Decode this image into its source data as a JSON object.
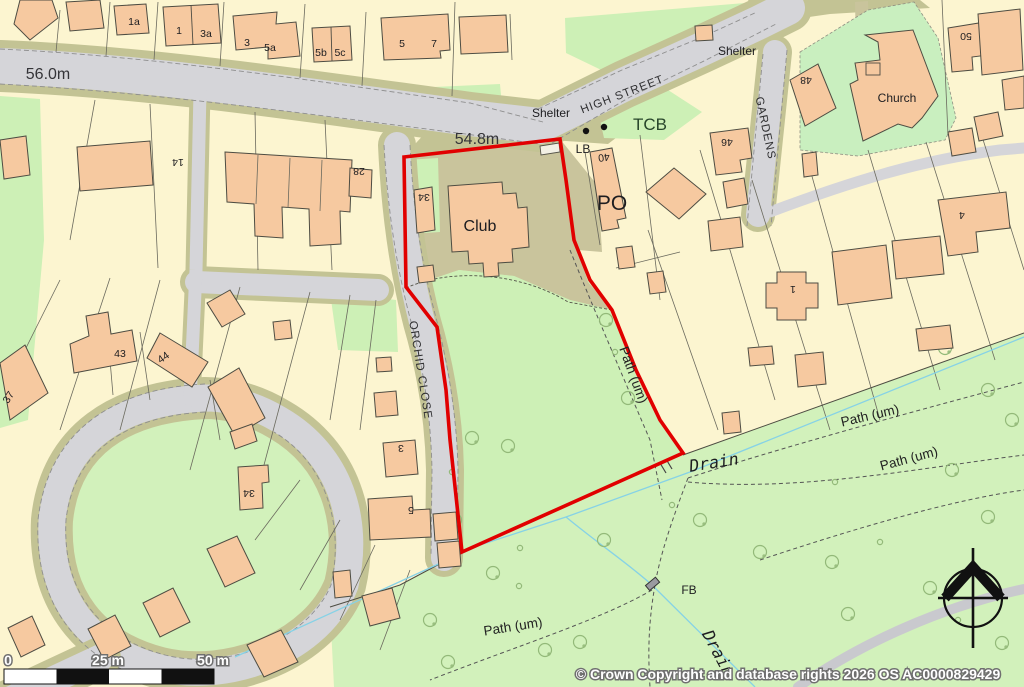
{
  "labels": {
    "spot_56": "56.0m",
    "spot_548": "54.8m",
    "high_street": "HIGH STREET",
    "gardens": "GARDENS",
    "orchid_close": "ORCHID CLOSE",
    "shelter_west": "Shelter",
    "shelter_east": "Shelter",
    "tcb": "TCB",
    "lb": "LB",
    "po": "PO",
    "club": "Club",
    "church": "Church",
    "fb": "FB",
    "path_um_west": "Path (um)",
    "path_um_mid": "Path (um)",
    "path_um_east": "Path (um)",
    "path_um_south": "Path (um)",
    "drain_upper": "Drain",
    "drain_lower": "Drain"
  },
  "nums": {
    "n1a": "1a",
    "n1": "1",
    "n3a": "3a",
    "n3": "3",
    "n5a": "5a",
    "n5b": "5b",
    "n5c": "5c",
    "n5": "5",
    "n7": "7",
    "n14": "14",
    "n28": "28",
    "n34w": "34",
    "n43": "43",
    "n44": "44",
    "n37": "37",
    "n34s": "34",
    "n5s": "5",
    "n3s": "3",
    "n40": "40",
    "n46": "46",
    "n48": "48",
    "n50": "50",
    "n4": "4",
    "n1e": "1"
  },
  "scale": {
    "start": "0",
    "mid": "25 m",
    "end": "50 m"
  },
  "copyright": {
    "text": "© Crown Copyright and database rights 2026 OS AC0000829429"
  },
  "colors": {
    "site_boundary": "#e10000",
    "water_label": "#2a9fe0",
    "road": "#d5d5d9",
    "verge": "#c3c394",
    "plot": "#fcf5d0",
    "grass": "#d2f1bb",
    "building": "#f6c9a0"
  }
}
